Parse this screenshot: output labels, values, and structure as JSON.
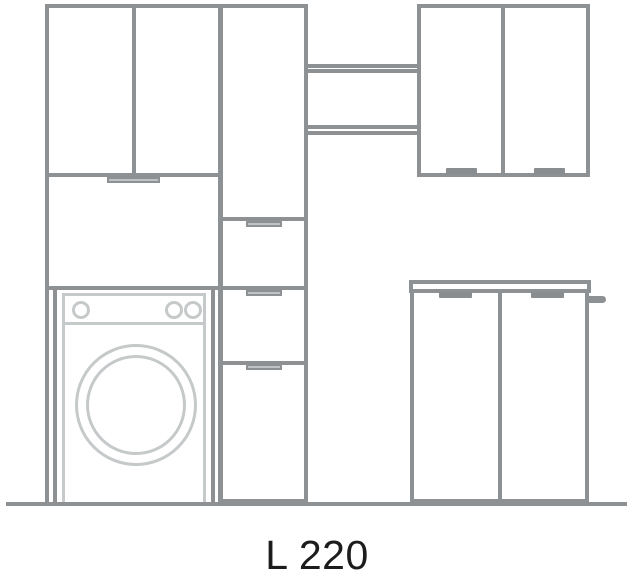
{
  "label": {
    "dimension": "L 220"
  },
  "colors": {
    "bg": "#ffffff",
    "line": "#8e9193",
    "light": "#c6c9ca",
    "handle": "#8a8d8f",
    "handle-light": "#c0c3c5",
    "ink": "#1c1c1c"
  }
}
